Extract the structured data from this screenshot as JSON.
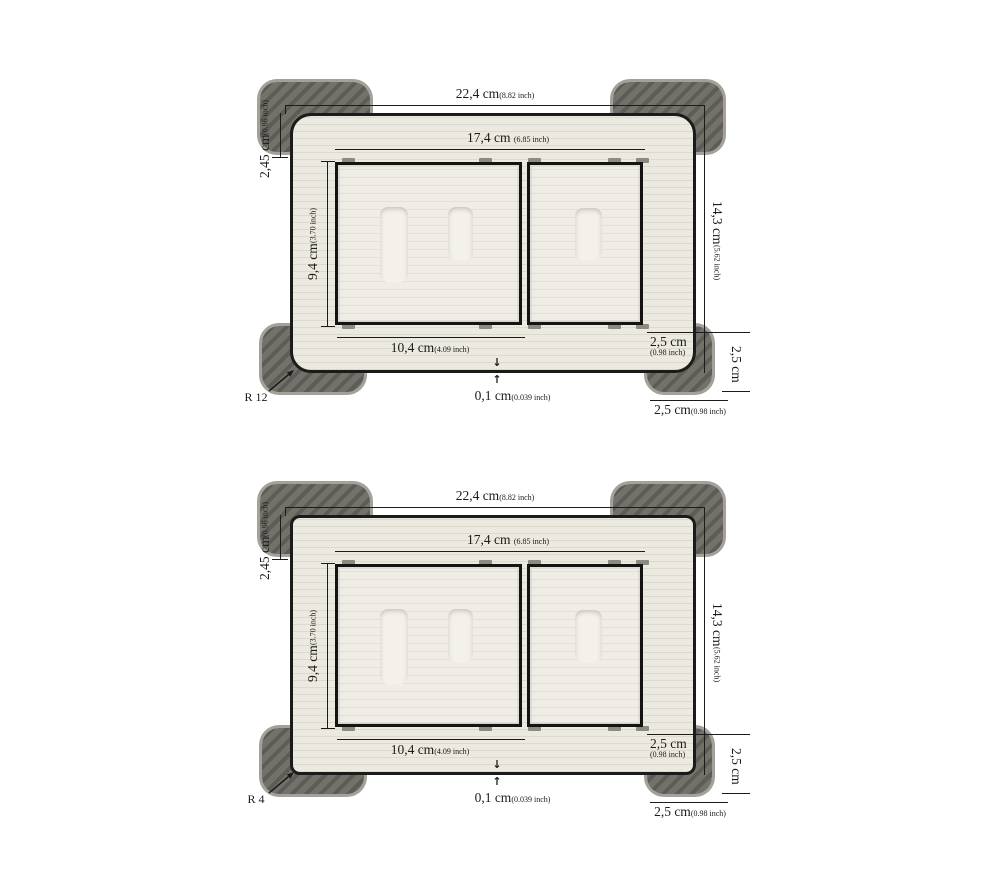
{
  "icons": {
    "down_arrow": "↓",
    "up_arrow": "↑"
  },
  "colors": {
    "bg": "#ffffff",
    "ink": "#1b1b1b",
    "plate": "#ece9e1",
    "plate_line": "#ddd9cd",
    "box_fill": "#f0ede6",
    "slot_fill": "#f3f1ea",
    "pad_dark": "#5e5c56",
    "pad_light": "#73716a",
    "pad_rim": "#a3a19a"
  },
  "diagrams": [
    {
      "radius": "R 12",
      "outer_width": {
        "cm": "22,4 cm",
        "inch": "(8.82 inch)"
      },
      "inner_width": {
        "cm": "17,4 cm",
        "inch": "(6.85 inch)"
      },
      "edge_height": {
        "cm": "2,45 cm",
        "inch": "(0.96 inch)"
      },
      "inner_height": {
        "cm": "9,4 cm",
        "inch": "(3.70 inch)"
      },
      "outer_height": {
        "cm": "14,3 cm",
        "inch": "(5.62 inch)"
      },
      "bottom_width": {
        "cm": "10,4 cm",
        "inch": "(4.09 inch)"
      },
      "corner_inset": {
        "cm": "2,5 cm",
        "inch": "(0.98 inch)"
      },
      "side_inset": {
        "cm": "2,5 cm"
      },
      "bottom_inset": {
        "cm": "2,5 cm",
        "inch": "(0.98 inch)"
      },
      "lip": {
        "cm": "0,1 cm",
        "inch": "(0.039 inch)"
      }
    },
    {
      "radius": "R 4",
      "outer_width": {
        "cm": "22,4 cm",
        "inch": "(8.82 inch)"
      },
      "inner_width": {
        "cm": "17,4 cm",
        "inch": "(6.85 inch)"
      },
      "edge_height": {
        "cm": "2,45 cm",
        "inch": "(0.96 inch)"
      },
      "inner_height": {
        "cm": "9,4 cm",
        "inch": "(3.70 inch)"
      },
      "outer_height": {
        "cm": "14,3 cm",
        "inch": "(5.62 inch)"
      },
      "bottom_width": {
        "cm": "10,4 cm",
        "inch": "(4.09 inch)"
      },
      "corner_inset": {
        "cm": "2,5 cm",
        "inch": "(0.98 inch)"
      },
      "side_inset": {
        "cm": "2,5 cm"
      },
      "bottom_inset": {
        "cm": "2,5 cm",
        "inch": "(0.98 inch)"
      },
      "lip": {
        "cm": "0,1 cm",
        "inch": "(0.039 inch)"
      }
    }
  ]
}
